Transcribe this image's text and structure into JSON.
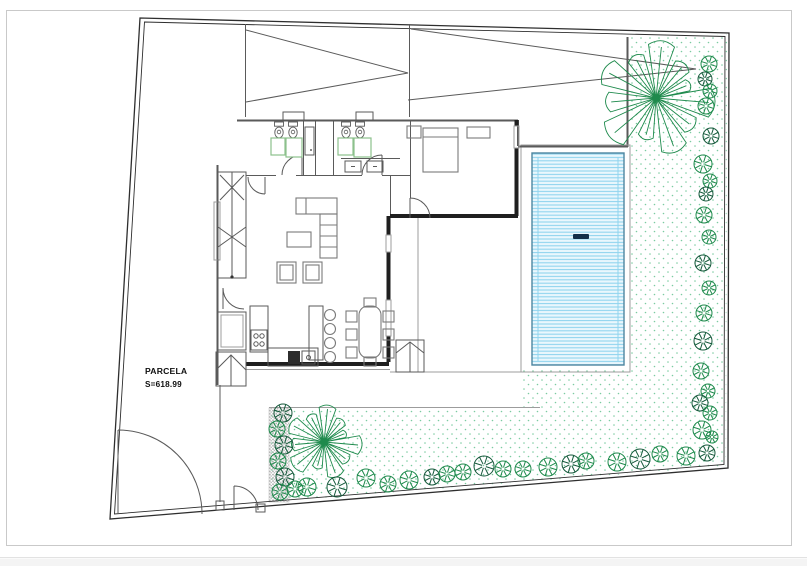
{
  "drawing": {
    "labels": {
      "parcel_name": "PARCELA",
      "parcel_area": "S=618.99"
    },
    "colors": {
      "wall": "#1f1f1f",
      "line": "#5a5a5a",
      "light_line": "#9c9c9c",
      "furniture": "#7a7a7a",
      "boundary": "#2e2e2e",
      "frame": "#c9c9c9",
      "text": "#0f0f0f",
      "pool_water": "#eaf7fd",
      "pool_stripe": "#90d4ee",
      "pool_edge": "#4e86a0",
      "pool_marker": "#122f49",
      "shower": "#8cc08c",
      "tree": "#1e8a4c",
      "tree_dark": "#15593b",
      "stipple": "#7ccba1",
      "hatch": "#ababab"
    },
    "vegetation": {
      "palms": [
        {
          "cx": 656,
          "cy": 98,
          "r": 62
        },
        {
          "cx": 324,
          "cy": 442,
          "r": 40
        }
      ],
      "bushes": [
        {
          "x": 709,
          "y": 64,
          "r": 8,
          "v": "light"
        },
        {
          "x": 705,
          "y": 79,
          "r": 7,
          "v": "dark"
        },
        {
          "x": 710,
          "y": 91,
          "r": 7,
          "v": "light"
        },
        {
          "x": 706,
          "y": 106,
          "r": 8,
          "v": "light"
        },
        {
          "x": 711,
          "y": 136,
          "r": 8,
          "v": "dark"
        },
        {
          "x": 703,
          "y": 164,
          "r": 9,
          "v": "light"
        },
        {
          "x": 710,
          "y": 181,
          "r": 7,
          "v": "light"
        },
        {
          "x": 706,
          "y": 194,
          "r": 7,
          "v": "dark"
        },
        {
          "x": 704,
          "y": 215,
          "r": 8,
          "v": "light"
        },
        {
          "x": 709,
          "y": 237,
          "r": 7,
          "v": "light"
        },
        {
          "x": 703,
          "y": 263,
          "r": 8,
          "v": "dark"
        },
        {
          "x": 709,
          "y": 288,
          "r": 7,
          "v": "light"
        },
        {
          "x": 704,
          "y": 313,
          "r": 8,
          "v": "light"
        },
        {
          "x": 703,
          "y": 341,
          "r": 9,
          "v": "dark"
        },
        {
          "x": 701,
          "y": 371,
          "r": 8,
          "v": "light"
        },
        {
          "x": 708,
          "y": 391,
          "r": 7,
          "v": "light"
        },
        {
          "x": 700,
          "y": 403,
          "r": 8,
          "v": "dark"
        },
        {
          "x": 710,
          "y": 413,
          "r": 7,
          "v": "light"
        },
        {
          "x": 702,
          "y": 430,
          "r": 9,
          "v": "light"
        },
        {
          "x": 712,
          "y": 437,
          "r": 6,
          "v": "light"
        },
        {
          "x": 707,
          "y": 453,
          "r": 8,
          "v": "dark"
        },
        {
          "x": 307,
          "y": 487,
          "r": 9,
          "v": "light"
        },
        {
          "x": 337,
          "y": 487,
          "r": 10,
          "v": "dark"
        },
        {
          "x": 366,
          "y": 478,
          "r": 9,
          "v": "light"
        },
        {
          "x": 388,
          "y": 484,
          "r": 8,
          "v": "light"
        },
        {
          "x": 409,
          "y": 480,
          "r": 9,
          "v": "light"
        },
        {
          "x": 432,
          "y": 477,
          "r": 8,
          "v": "dark"
        },
        {
          "x": 447,
          "y": 474,
          "r": 8,
          "v": "light"
        },
        {
          "x": 463,
          "y": 472,
          "r": 8,
          "v": "light"
        },
        {
          "x": 484,
          "y": 466,
          "r": 10,
          "v": "dark"
        },
        {
          "x": 503,
          "y": 469,
          "r": 8,
          "v": "light"
        },
        {
          "x": 523,
          "y": 469,
          "r": 8,
          "v": "light"
        },
        {
          "x": 548,
          "y": 467,
          "r": 9,
          "v": "light"
        },
        {
          "x": 571,
          "y": 464,
          "r": 9,
          "v": "dark"
        },
        {
          "x": 586,
          "y": 461,
          "r": 8,
          "v": "light"
        },
        {
          "x": 617,
          "y": 462,
          "r": 9,
          "v": "light"
        },
        {
          "x": 640,
          "y": 459,
          "r": 10,
          "v": "dark"
        },
        {
          "x": 660,
          "y": 454,
          "r": 8,
          "v": "light"
        },
        {
          "x": 686,
          "y": 456,
          "r": 9,
          "v": "light"
        },
        {
          "x": 283,
          "y": 413,
          "r": 9,
          "v": "dark"
        },
        {
          "x": 277,
          "y": 429,
          "r": 8,
          "v": "light"
        },
        {
          "x": 284,
          "y": 445,
          "r": 9,
          "v": "dark"
        },
        {
          "x": 278,
          "y": 461,
          "r": 8,
          "v": "light"
        },
        {
          "x": 285,
          "y": 477,
          "r": 9,
          "v": "dark"
        },
        {
          "x": 280,
          "y": 492,
          "r": 8,
          "v": "light"
        },
        {
          "x": 295,
          "y": 489,
          "r": 8,
          "v": "light"
        }
      ]
    }
  }
}
